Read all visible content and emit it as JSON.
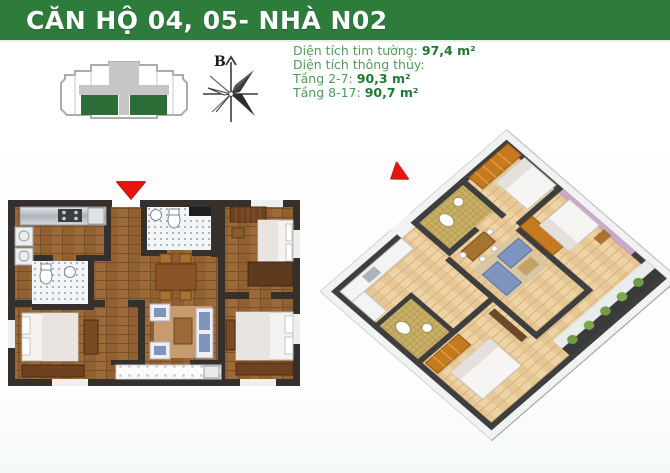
{
  "header": {
    "title": "CĂN HỘ 04, 05- NHÀ N02"
  },
  "info": {
    "tim_tuong_label": "Diện tích tim tường:",
    "tim_tuong_value": "97,4 m²",
    "thong_thuy_label": "Diện tích thông thủy:",
    "tang_2_7_label": "Tầng 2-7:",
    "tang_2_7_value": "90,3 m²",
    "tang_8_17_label": "Tầng 8-17:",
    "tang_8_17_value": "90,7 m²"
  },
  "compass": {
    "north_label": "B"
  },
  "colors": {
    "header_bg": "#2e7c3c",
    "info_text": "#4f9d5c",
    "info_value": "#1a7a2f",
    "unit_highlight_green": "#2c6e38",
    "arrow_red": "#e8140e",
    "wall_dark_2d": "#35302c",
    "wall_dark_3d": "#3e3e3e",
    "wood_floor_2d": "#916030",
    "wood_floor_3d": "#e7c795",
    "wardrobe_orange": "#c67a1f",
    "bedroom_wall_purple": "#c9a8ca",
    "sofa_blue": "#7e95c0"
  }
}
